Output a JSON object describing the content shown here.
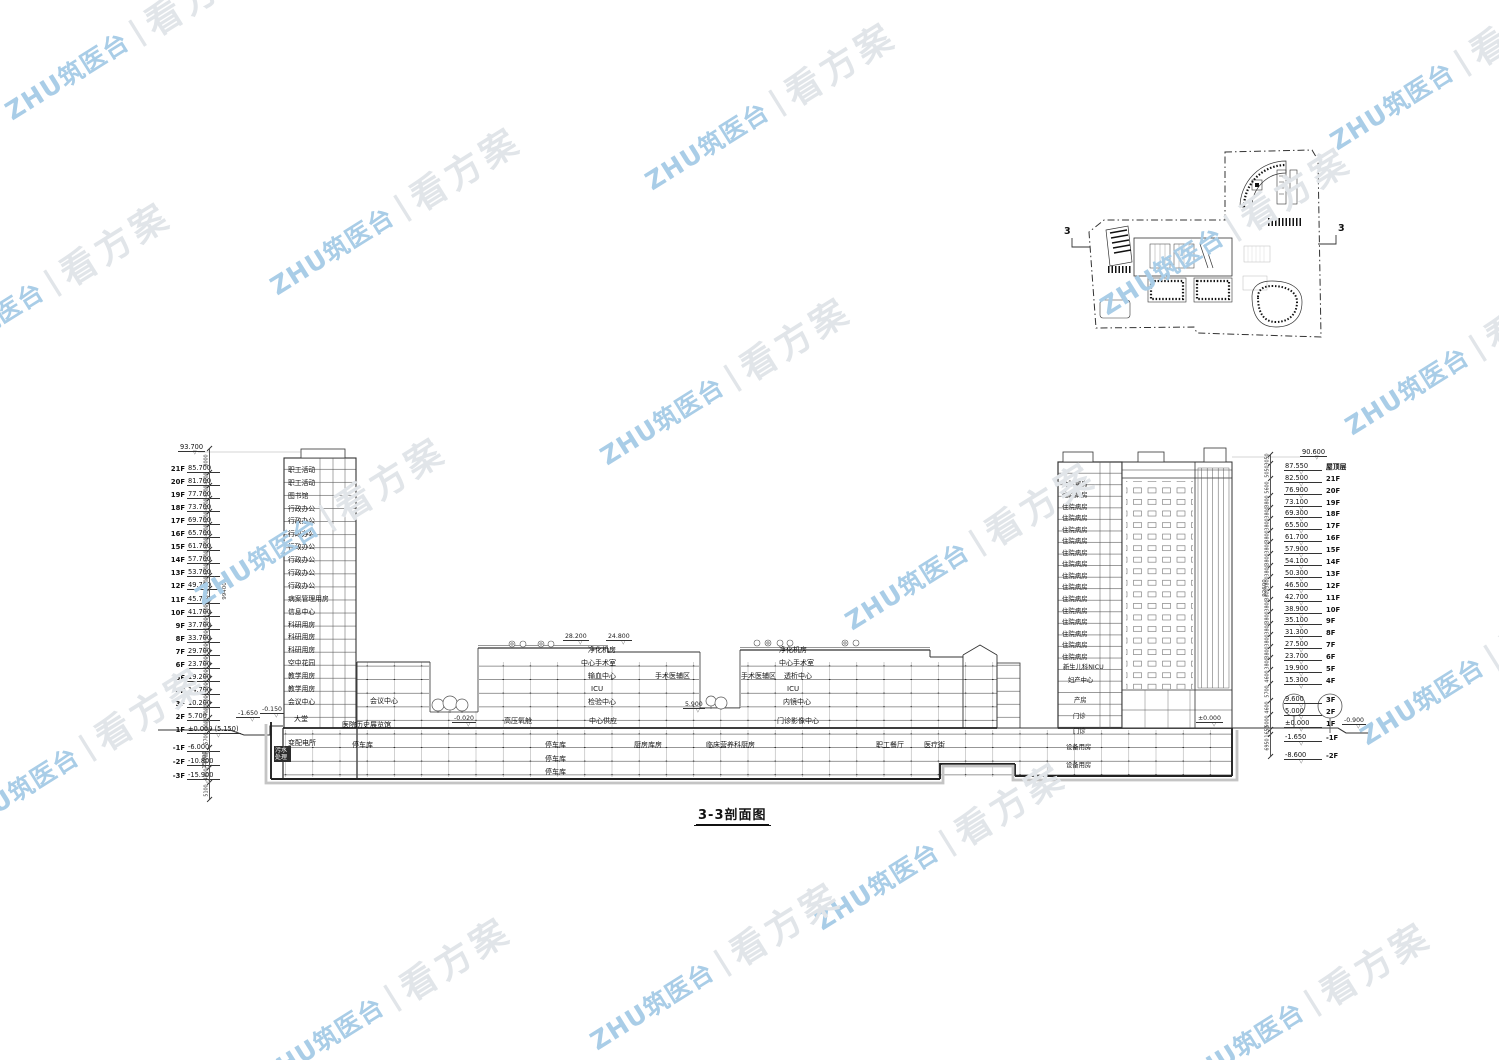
{
  "title": {
    "text": "3-3剖面图"
  },
  "watermark": {
    "brand": "ZHU筑医台",
    "divider": "|",
    "slogan": "看方案",
    "brand_color": "#a9cde7",
    "slogan_color": "#e1e5e9"
  },
  "site_plan": {
    "section_label_left": "3",
    "section_label_right": "3"
  },
  "left_levels": {
    "top_elevation": "93.700",
    "floors": [
      {
        "floor": "21F",
        "elev": "85.700"
      },
      {
        "floor": "20F",
        "elev": "81.700"
      },
      {
        "floor": "19F",
        "elev": "77.700"
      },
      {
        "floor": "18F",
        "elev": "73.700"
      },
      {
        "floor": "17F",
        "elev": "69.700"
      },
      {
        "floor": "16F",
        "elev": "65.700"
      },
      {
        "floor": "15F",
        "elev": "61.700"
      },
      {
        "floor": "14F",
        "elev": "57.700"
      },
      {
        "floor": "13F",
        "elev": "53.700"
      },
      {
        "floor": "12F",
        "elev": "49.700"
      },
      {
        "floor": "11F",
        "elev": "45.700"
      },
      {
        "floor": "10F",
        "elev": "41.700"
      },
      {
        "floor": "9F",
        "elev": "37.700"
      },
      {
        "floor": "8F",
        "elev": "33.700"
      },
      {
        "floor": "7F",
        "elev": "29.700"
      },
      {
        "floor": "6F",
        "elev": "23.700"
      },
      {
        "floor": "5F",
        "elev": "19.200"
      },
      {
        "floor": "4F",
        "elev": "14.700"
      },
      {
        "floor": "3F",
        "elev": "10.200"
      },
      {
        "floor": "2F",
        "elev": "5.700"
      },
      {
        "floor": "1F",
        "elev": "±0.000 (5.150)"
      }
    ],
    "basement": [
      {
        "floor": "-1F",
        "elev": "-6.000"
      },
      {
        "floor": "-2F",
        "elev": "-10.800"
      },
      {
        "floor": "-3F",
        "elev": "-15.900"
      }
    ],
    "dims": {
      "segments": [
        "8000",
        "4000",
        "4000",
        "4000",
        "4000",
        "4000",
        "4000",
        "4000",
        "4000",
        "4000",
        "4000",
        "4000",
        "4000",
        "4000",
        "4000",
        "4000",
        "4000",
        "4000",
        "4000",
        "4000",
        "4000",
        "5700",
        "6000",
        "4800",
        "5100"
      ],
      "overall": "99400",
      "lower_overall": "15900"
    }
  },
  "right_levels": {
    "top_elevation": "90.600",
    "floors": [
      {
        "elev": "87.550",
        "floor": "屋顶层"
      },
      {
        "elev": "82.500",
        "floor": "21F"
      },
      {
        "elev": "76.900",
        "floor": "20F"
      },
      {
        "elev": "73.100",
        "floor": "19F"
      },
      {
        "elev": "69.300",
        "floor": "18F"
      },
      {
        "elev": "65.500",
        "floor": "17F"
      },
      {
        "elev": "61.700",
        "floor": "16F"
      },
      {
        "elev": "57.900",
        "floor": "15F"
      },
      {
        "elev": "54.100",
        "floor": "14F"
      },
      {
        "elev": "50.300",
        "floor": "13F"
      },
      {
        "elev": "46.500",
        "floor": "12F"
      },
      {
        "elev": "42.700",
        "floor": "11F"
      },
      {
        "elev": "38.900",
        "floor": "10F"
      },
      {
        "elev": "35.100",
        "floor": "9F"
      },
      {
        "elev": "31.300",
        "floor": "8F"
      },
      {
        "elev": "27.500",
        "floor": "7F"
      },
      {
        "elev": "23.700",
        "floor": "6F"
      },
      {
        "elev": "19.900",
        "floor": "5F"
      },
      {
        "elev": "15.300",
        "floor": "4F"
      },
      {
        "elev": "9.600",
        "floor": "3F"
      },
      {
        "elev": "5.000",
        "floor": "2F"
      },
      {
        "elev": "±0.000",
        "floor": "1F"
      },
      {
        "elev": "-1.650",
        "floor": "-1F"
      },
      {
        "elev": "-8.600",
        "floor": "-2F"
      }
    ],
    "dims": {
      "segments": [
        "3050",
        "5050",
        "5600",
        "3800",
        "3800",
        "3800",
        "3800",
        "3800",
        "3800",
        "3800",
        "3800",
        "3800",
        "3800",
        "3800",
        "3800",
        "3800",
        "3800",
        "3800",
        "4600",
        "5700",
        "4600",
        "5000",
        "1650",
        "6950"
      ],
      "overall": "92600"
    }
  },
  "left_tower": {
    "rooms": [
      "职工活动",
      "职工活动",
      "图书馆",
      "行政办公",
      "行政办公",
      "行政办公",
      "行政办公",
      "行政办公",
      "行政办公",
      "行政办公",
      "病案管理用房",
      "信息中心",
      "科研用房",
      "科研用房",
      "科研用房",
      "空中花园",
      "教学用房",
      "教学用房",
      "会议中心"
    ]
  },
  "right_tower": {
    "wards": [
      "住院病房",
      "住院病房",
      "住院病房",
      "住院病房",
      "住院病房",
      "住院病房",
      "住院病房",
      "住院病房",
      "住院病房",
      "住院病房",
      "住院病房",
      "住院病房",
      "住院病房",
      "住院病房",
      "住院病房",
      "住院病房"
    ],
    "rooms": [
      "新生儿科NICU",
      "妇产中心",
      "产房",
      "门诊",
      "门诊",
      "设备用房",
      "设备用房"
    ]
  },
  "podium": {
    "labels": [
      "净化机房",
      "净化机房",
      "中心手术室",
      "中心手术室",
      "输血中心",
      "手术医辅区",
      "手术医辅区",
      "透析中心",
      "ICU",
      "ICU",
      "检验中心",
      "内镜中心",
      "中心供应",
      "门诊影像中心",
      "会议中心",
      "大堂",
      "医院历史展览馆",
      "高压氧舱",
      "变配电所",
      "污水处理",
      "停车库",
      "停车库",
      "停车库",
      "停车库",
      "厨房库房",
      "临床营养科厨房",
      "职工餐厅",
      "医疗街"
    ]
  },
  "elevation_tags": {
    "roof_left": "28.200",
    "roof_right": "24.800",
    "courtyard": "-0.020",
    "atrium": "5.900",
    "entry_low": "-1.650",
    "entry_high": "-0.150",
    "right_ground": "±0.000",
    "right_slope": "-0.900"
  }
}
